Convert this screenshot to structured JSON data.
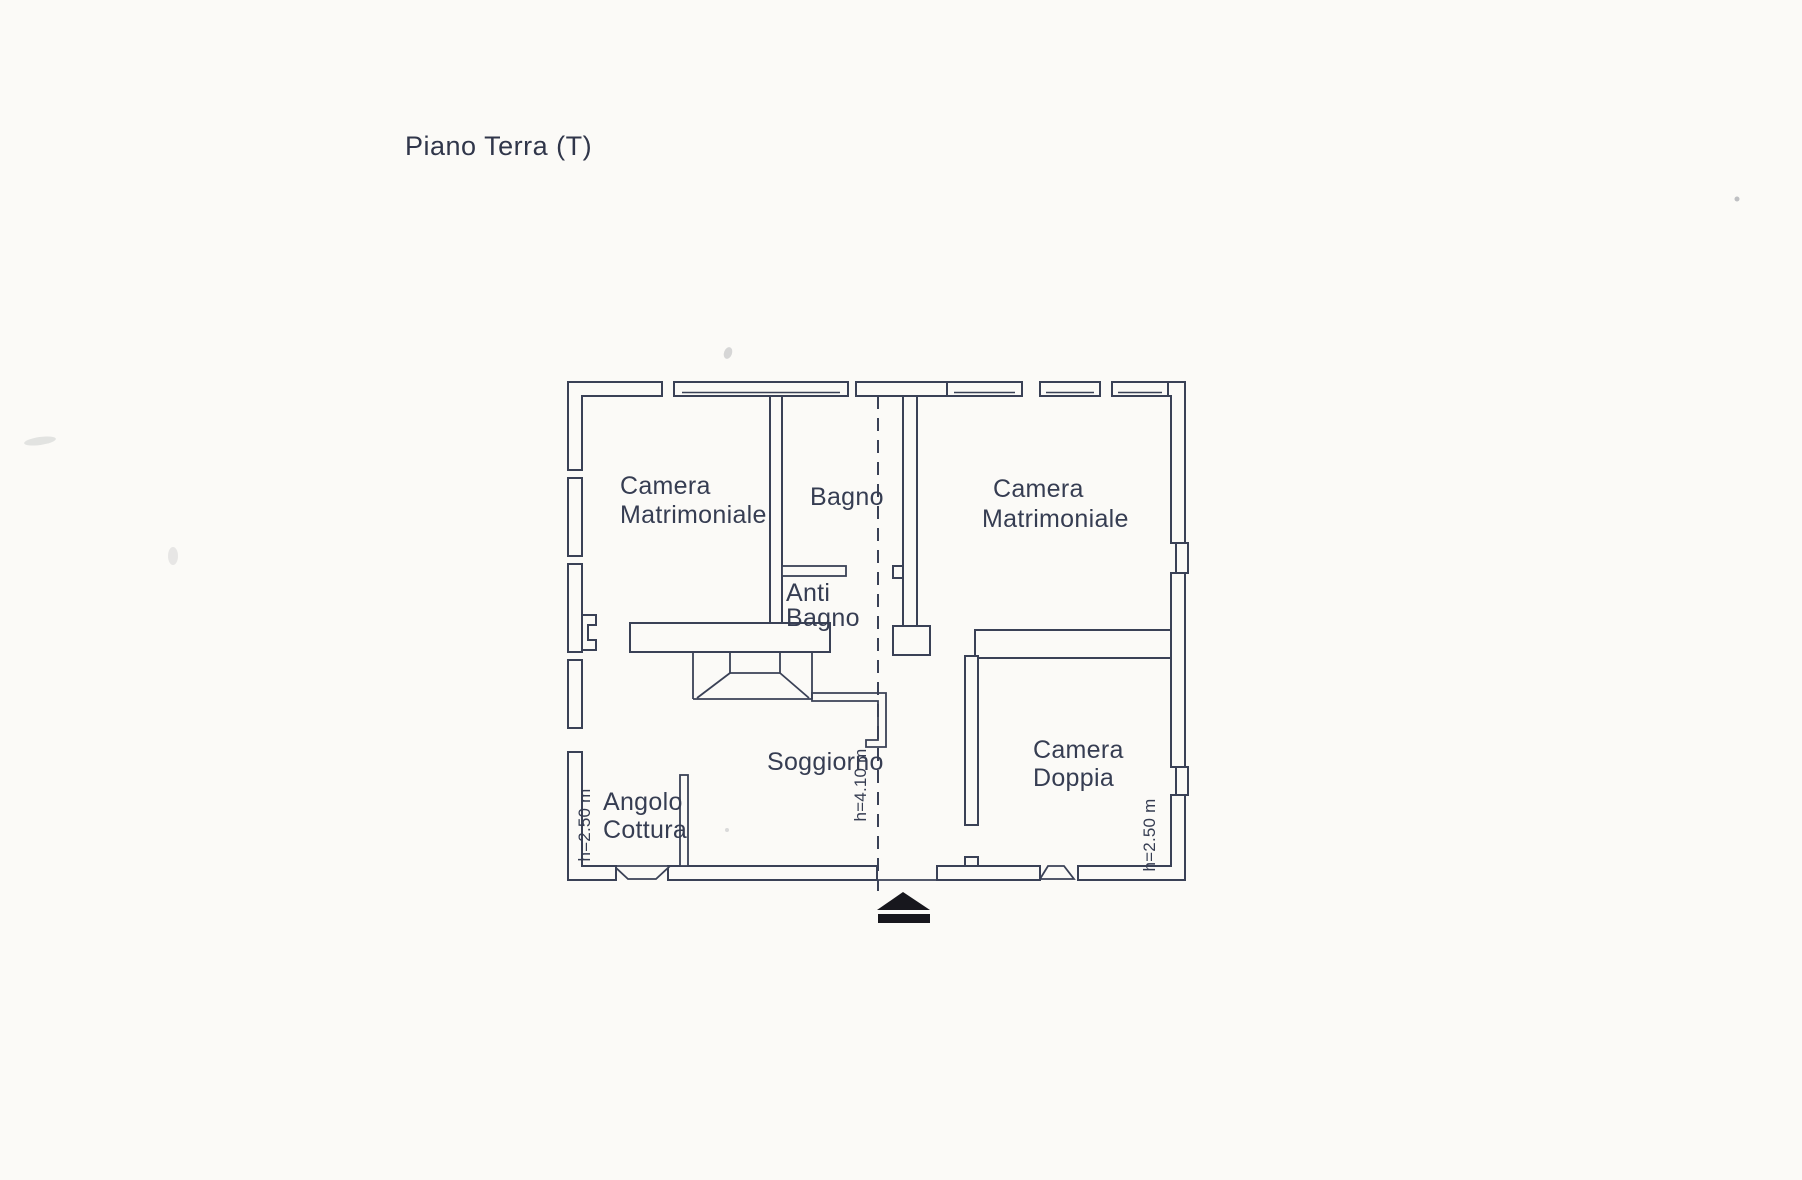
{
  "document": {
    "title": "Piano Terra (T)"
  },
  "floorplan": {
    "rooms": [
      {
        "key": "camera-matrimoniale-left",
        "lines": [
          "Camera",
          "Matrimoniale"
        ]
      },
      {
        "key": "bagno",
        "lines": [
          "Bagno"
        ]
      },
      {
        "key": "anti-bagno",
        "lines": [
          "Anti",
          "Bagno"
        ]
      },
      {
        "key": "camera-matrimoniale-right",
        "lines": [
          "Camera",
          "Matrimoniale"
        ]
      },
      {
        "key": "camera-doppia",
        "lines": [
          "Camera",
          "Doppia"
        ]
      },
      {
        "key": "soggiorno",
        "lines": [
          "Soggiorno"
        ]
      },
      {
        "key": "angolo-cottura",
        "lines": [
          "Angolo",
          "Cottura"
        ]
      }
    ],
    "ceiling_heights": [
      {
        "position": "left",
        "label": "h=2.50 m"
      },
      {
        "position": "center",
        "label": "h=4.10 m"
      },
      {
        "position": "right",
        "label": "h=2.50 m"
      }
    ],
    "colors": {
      "ink": "#3a4156",
      "paper": "#fbfaf7",
      "entrance_marker": "#17171d"
    }
  }
}
